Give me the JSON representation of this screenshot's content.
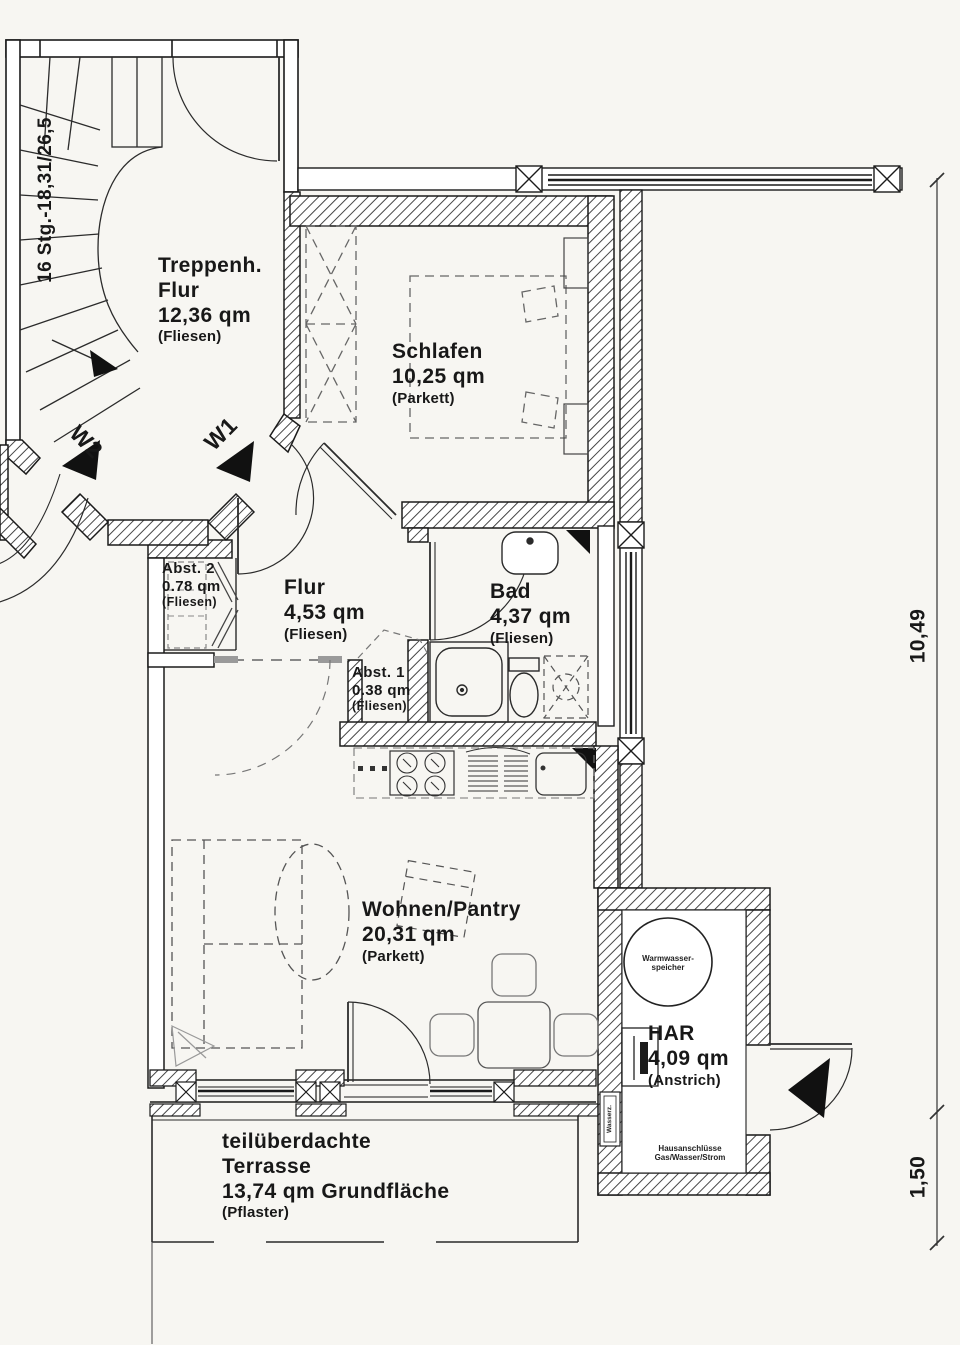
{
  "rooms": {
    "treppenhaus": {
      "line1": "Treppenh.",
      "line2": "Flur",
      "area": "12,36 qm",
      "finish": "(Fliesen)"
    },
    "schlafen": {
      "name": "Schlafen",
      "area": "10,25 qm",
      "finish": "(Parkett)"
    },
    "flur": {
      "name": "Flur",
      "area": "4,53 qm",
      "finish": "(Fliesen)"
    },
    "abst2": {
      "name": "Abst. 2",
      "area": "0.78 qm",
      "finish": "(Fliesen)"
    },
    "abst1": {
      "name": "Abst. 1",
      "area": "0.38 qm",
      "finish": "(Fliesen)"
    },
    "bad": {
      "name": "Bad",
      "area": "4,37 qm",
      "finish": "(Fliesen)"
    },
    "wohnen": {
      "name": "Wohnen/Pantry",
      "area": "20,31 qm",
      "finish": "(Parkett)"
    },
    "har": {
      "name": "HAR",
      "area": "4,09 qm",
      "finish": "(Anstrich)"
    },
    "terrasse": {
      "line1": "teilüberdachte",
      "line2": "Terrasse",
      "area": "13,74 qm Grundfläche",
      "finish": "(Pflaster)"
    }
  },
  "annotations": {
    "stairs": "16 Stg.-18,31/26,5",
    "w1": "W1",
    "w2": "W2",
    "dim_total": "10,49",
    "dim_terrace": "1,50",
    "heater1": "Warmwasser-",
    "heater2": "speicher",
    "meter": "Wasserz.",
    "conn1": "Hausanschlüsse",
    "conn2": "Gas/Wasser/Strom"
  },
  "colors": {
    "ink": "#1b1b1b",
    "paper": "#f7f6f2",
    "furniture": "#555555"
  }
}
